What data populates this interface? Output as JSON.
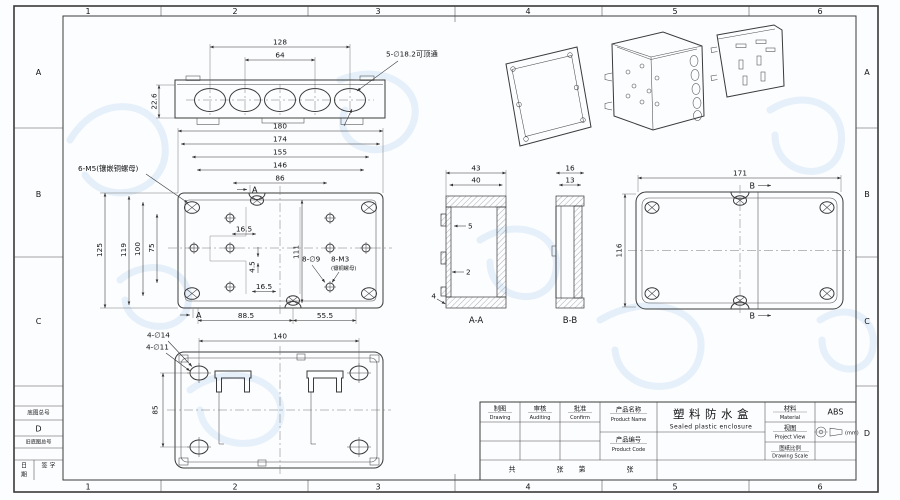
{
  "colors": {
    "paper": "#fcfdff",
    "line": "#3a3a3a",
    "watermark": "#cfe3f5"
  },
  "sheet": {
    "zone_numbers": [
      "1",
      "2",
      "3",
      "4",
      "5",
      "6"
    ],
    "zone_letters": [
      "A",
      "B",
      "C",
      "D"
    ],
    "corner_block": {
      "base_label": "底图总号",
      "old_base_label": "旧底图总号",
      "date_top": "日",
      "date_bottom": "期",
      "sign_label": "签 字"
    }
  },
  "title_block": {
    "drawing_zh": "制图",
    "drawing_en": "Drawing",
    "audit_zh": "审核",
    "audit_en": "Auditing",
    "confirm_zh": "批准",
    "confirm_en": "Confirm",
    "product_name_zh": "产品名称",
    "product_name_en": "Product Name",
    "product_code_zh": "产品编号",
    "product_code_en": "Product Code",
    "name_value_zh": "塑料防水盒",
    "name_value_en": "Sealed plastic enclosure",
    "material_zh": "材料",
    "material_en": "Material",
    "material_value": "ABS",
    "view_zh": "视图",
    "view_en": "Project View",
    "scale_zh": "图纸比例",
    "scale_en": "Drawing Scale",
    "unit_label": "(mm)",
    "total_label": "共",
    "pages_label": "张",
    "no_label": "第",
    "pages_label2": "张"
  },
  "views": {
    "top": {
      "dim_outer": "128",
      "dim_inner": "64",
      "dim_height": "22.6",
      "hole_note": "5-∅18.2可顶通"
    },
    "front": {
      "insert_note": "6-M5(镶嵌铜螺母)",
      "w_dims": [
        "180",
        "174",
        "155",
        "146",
        "86"
      ],
      "h_dims": [
        "125",
        "119",
        "100",
        "75"
      ],
      "dim_165_top": "16.5",
      "dim_45": "4.5",
      "dim_111": "111",
      "dim_165_bottom": "16.5",
      "dim_885": "88.5",
      "dim_555": "55.5",
      "hole_note": "8-∅9",
      "thread_note": "8-M3",
      "thread_sub": "(镶铜螺母)",
      "marker": "A"
    },
    "section_aa": {
      "dim_w_outer": "43",
      "dim_w_inner": "40",
      "dim_step": "5",
      "dim_wall": "2",
      "dim_base": "4",
      "label": "A-A"
    },
    "section_bb": {
      "dim_w_outer": "16",
      "dim_w_inner": "13",
      "label": "B-B"
    },
    "back": {
      "dim_w": "171",
      "dim_h": "116",
      "marker": "B"
    },
    "bottom": {
      "hole_note_outer": "4-∅14",
      "hole_note_inner": "4-∅11",
      "dim_w": "140",
      "dim_h": "85"
    }
  }
}
